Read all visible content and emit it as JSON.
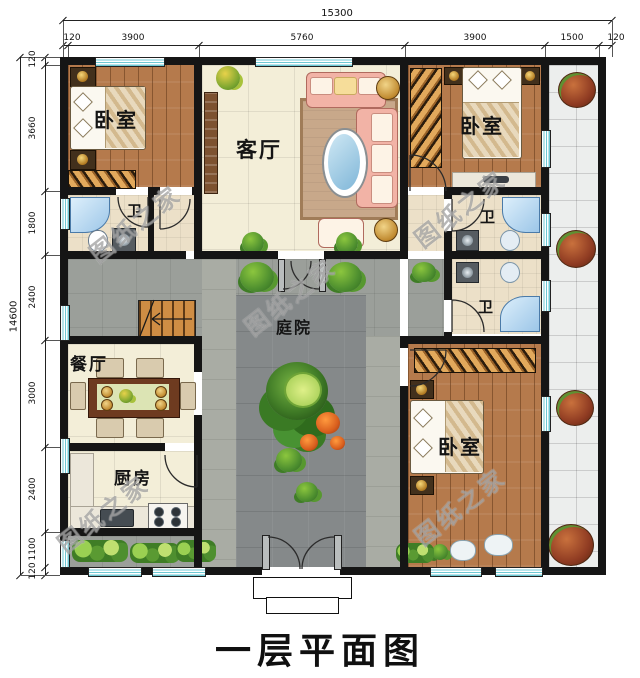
{
  "title": "一层平面图",
  "watermark": "图纸之家",
  "dimensions": {
    "top": {
      "total": "15300",
      "segments": [
        "120",
        "3900",
        "5760",
        "3900",
        "1500",
        "120"
      ]
    },
    "left": {
      "total": "14600",
      "segments": [
        "120",
        "3660",
        "1800",
        "2400",
        "3000",
        "2400",
        "1100",
        "120"
      ]
    }
  },
  "rooms": {
    "bedroom_top_left": "卧室",
    "living_room": "客厅",
    "bedroom_top_right": "卧室",
    "bath_left": "卫",
    "bath_right_upper": "卫",
    "bath_right_lower": "卫",
    "dining_room": "餐厅",
    "courtyard": "庭院",
    "kitchen": "厨房",
    "bedroom_bottom_right": "卧室"
  },
  "colors": {
    "wall": "#151515",
    "window_glass": "#6fc9d4",
    "wood_floor": "#b57a4c",
    "tile_floor": "#f3eed8",
    "courtyard_paving": "#85898a",
    "porch_tile": "#eceeed",
    "sofa": "#f2b3a6",
    "shower": "#9cc6e8",
    "plant_green": "#3f7a26",
    "shrub_red": "#8f3b22"
  }
}
